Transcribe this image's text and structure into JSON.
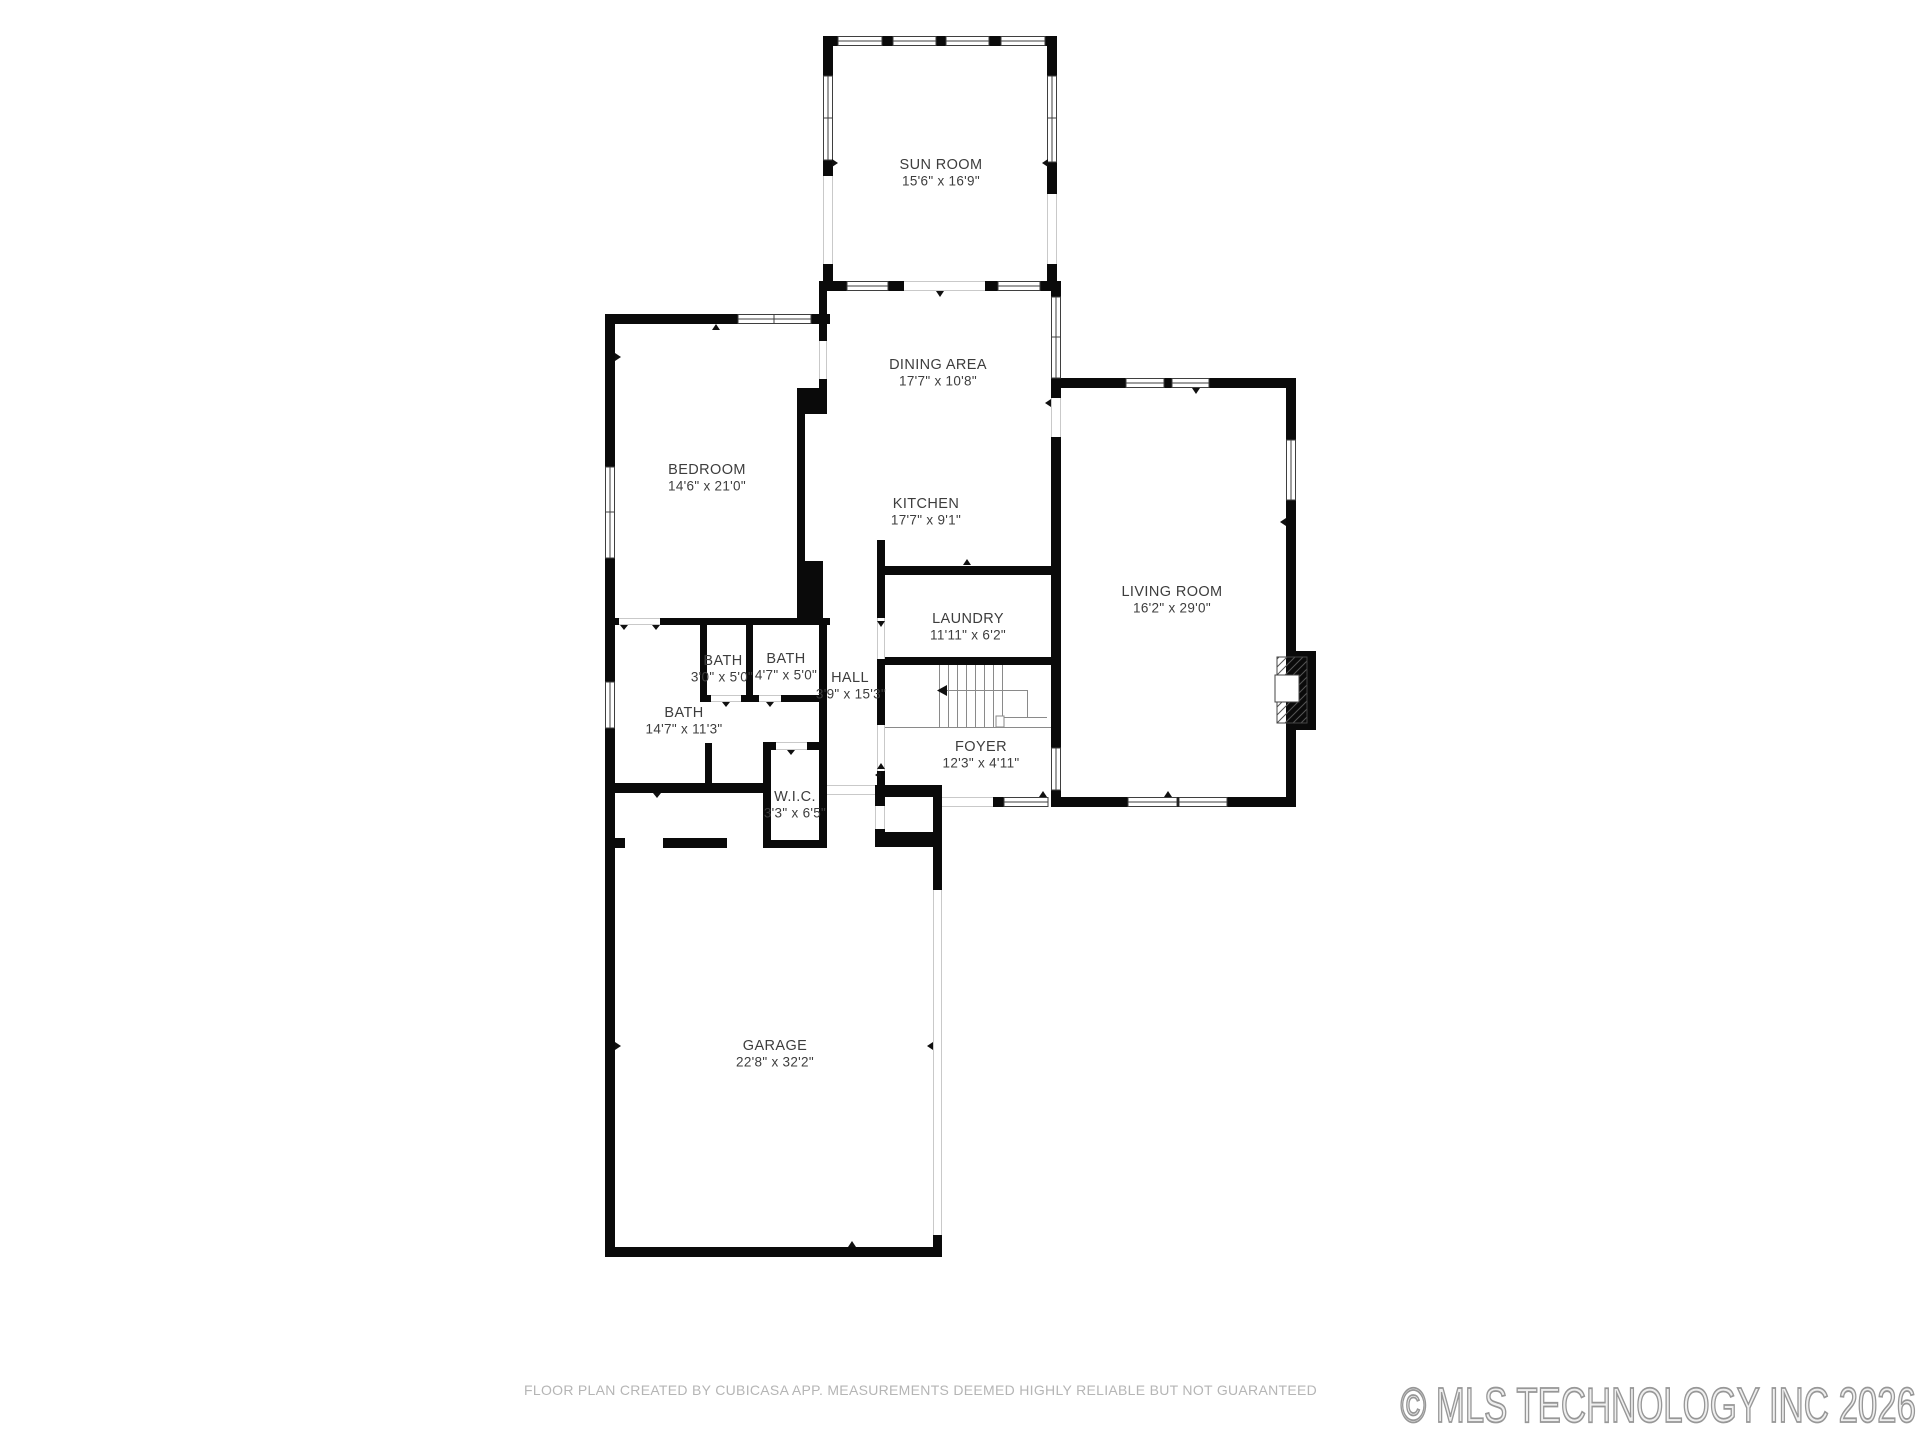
{
  "rooms": {
    "sunroom": {
      "name": "SUN ROOM",
      "dims": "15'6\" x 16'9\""
    },
    "dining": {
      "name": "DINING AREA",
      "dims": "17'7\" x 10'8\""
    },
    "bedroom": {
      "name": "BEDROOM",
      "dims": "14'6\" x 21'0\""
    },
    "kitchen": {
      "name": "KITCHEN",
      "dims": "17'7\" x 9'1\""
    },
    "laundry": {
      "name": "LAUNDRY",
      "dims": "11'11\" x 6'2\""
    },
    "bath_1": {
      "name": "BATH",
      "dims": "3'0\" x 5'0\""
    },
    "bath_2": {
      "name": "BATH",
      "dims": "4'7\" x 5'0\""
    },
    "hall": {
      "name": "HALL",
      "dims": "3'9\" x 15'3\""
    },
    "bath_main": {
      "name": "BATH",
      "dims": "14'7\" x 11'3\""
    },
    "wic": {
      "name": "W.I.C.",
      "dims": "3'3\" x 6'5\""
    },
    "foyer": {
      "name": "FOYER",
      "dims": "12'3\" x 4'11\""
    },
    "living": {
      "name": "LIVING ROOM",
      "dims": "16'2\" x 29'0\""
    },
    "garage": {
      "name": "GARAGE",
      "dims": "22'8\" x 32'2\""
    }
  },
  "footer": {
    "disclaimer": "FLOOR PLAN CREATED BY CUBICASA APP. MEASUREMENTS DEEMED HIGHLY RELIABLE BUT NOT GUARANTEED"
  },
  "watermark": {
    "text": "© MLS TECHNOLOGY INC 2026"
  },
  "colors": {
    "wall": "#0a0a0a",
    "label": "#3d3d3d",
    "disclaimer": "#b5b5b5",
    "watermark": "#979797"
  }
}
